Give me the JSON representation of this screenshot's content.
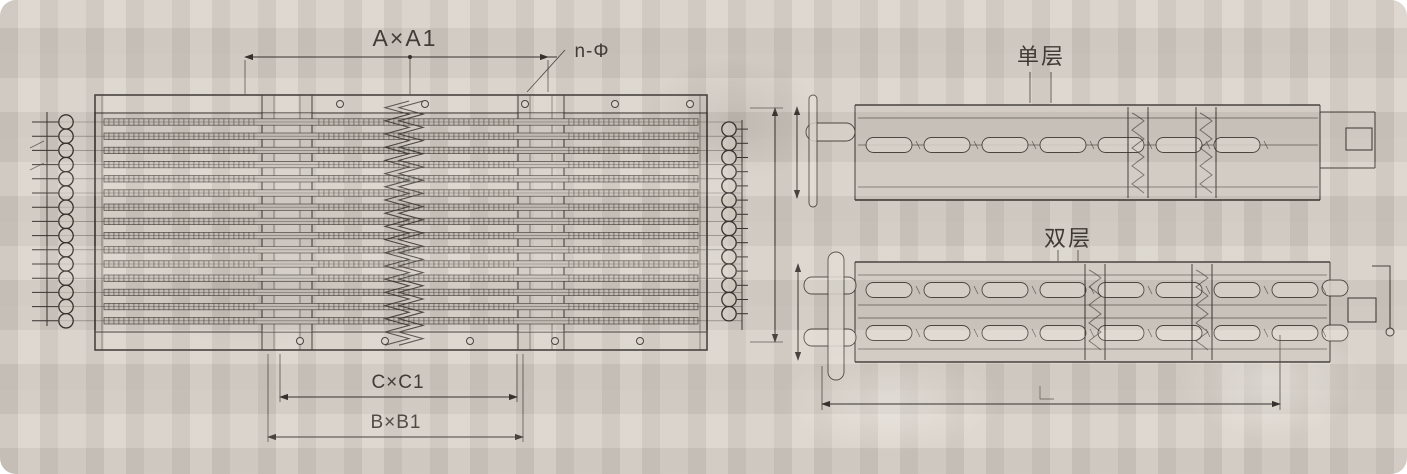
{
  "colors": {
    "paper": "#d7d1c9",
    "ink": "#35302c"
  },
  "front_view": {
    "dim_width_label": "A×A1",
    "holes_label": "n-Φ",
    "dim_c_label": "C×C1",
    "dim_b_label": "B×B1",
    "tube_rows": 15,
    "left_bends": 15,
    "right_bends": 14
  },
  "side_views": {
    "single_layer_label": "单层",
    "double_layer_label": "双层"
  }
}
